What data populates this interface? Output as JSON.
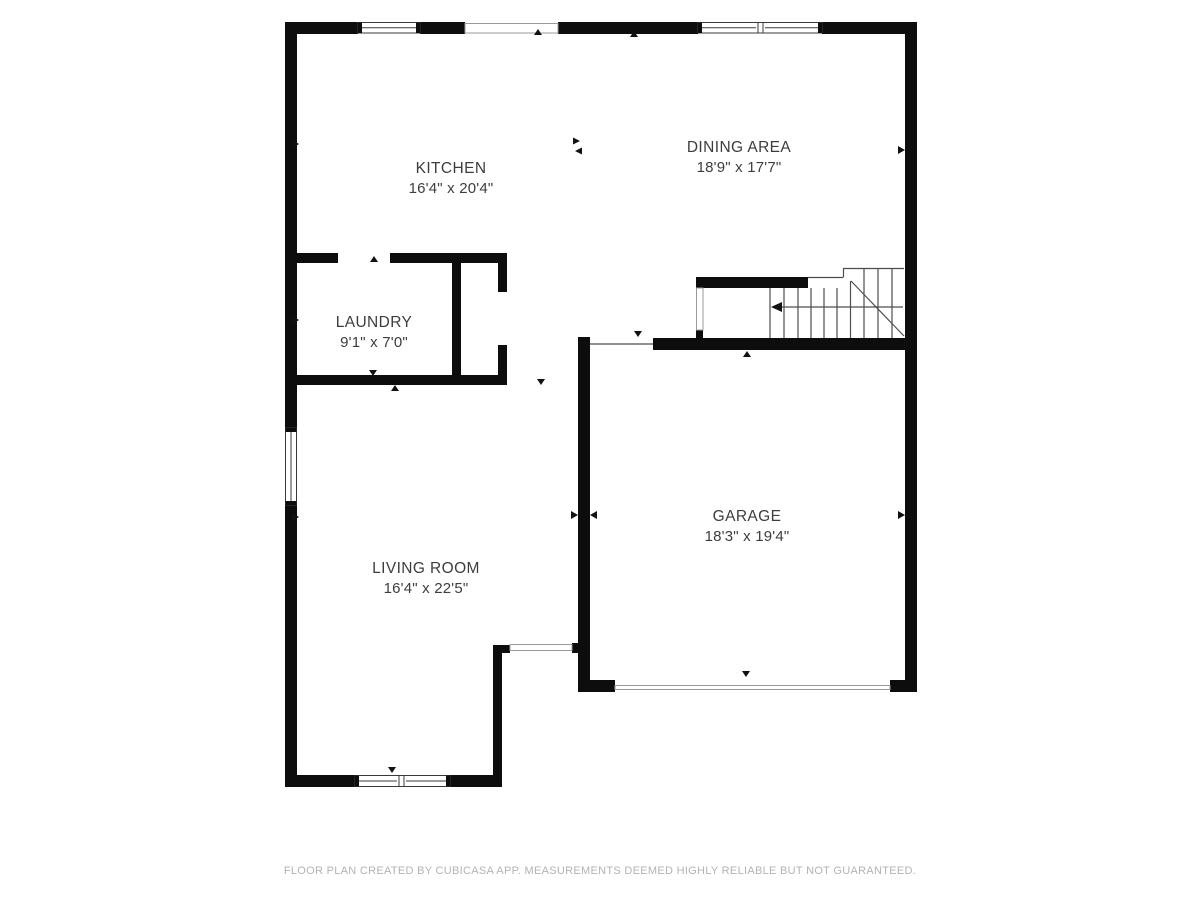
{
  "floorplan": {
    "rooms": [
      {
        "id": "kitchen",
        "name": "KITCHEN",
        "dimensions": "16'4\" x 20'4\""
      },
      {
        "id": "dining-area",
        "name": "DINING AREA",
        "dimensions": "18'9\" x 17'7\""
      },
      {
        "id": "laundry",
        "name": "LAUNDRY",
        "dimensions": "9'1\" x 7'0\""
      },
      {
        "id": "living-room",
        "name": "LIVING ROOM",
        "dimensions": "16'4\" x 22'5\""
      },
      {
        "id": "garage",
        "name": "GARAGE",
        "dimensions": "18'3\" x 19'4\""
      }
    ],
    "footer": "FLOOR PLAN CREATED BY CUBICASA APP. MEASUREMENTS DEEMED HIGHLY RELIABLE BUT NOT GUARANTEED.",
    "colors": {
      "wall": "#0d0d0d",
      "label": "#3d3d3d",
      "footer": "#b3b3b3",
      "stair_line": "#4d4d4d",
      "opening_border": "#9a9a9a",
      "window_border": "#3a3a3a",
      "marker": "#111111"
    }
  }
}
